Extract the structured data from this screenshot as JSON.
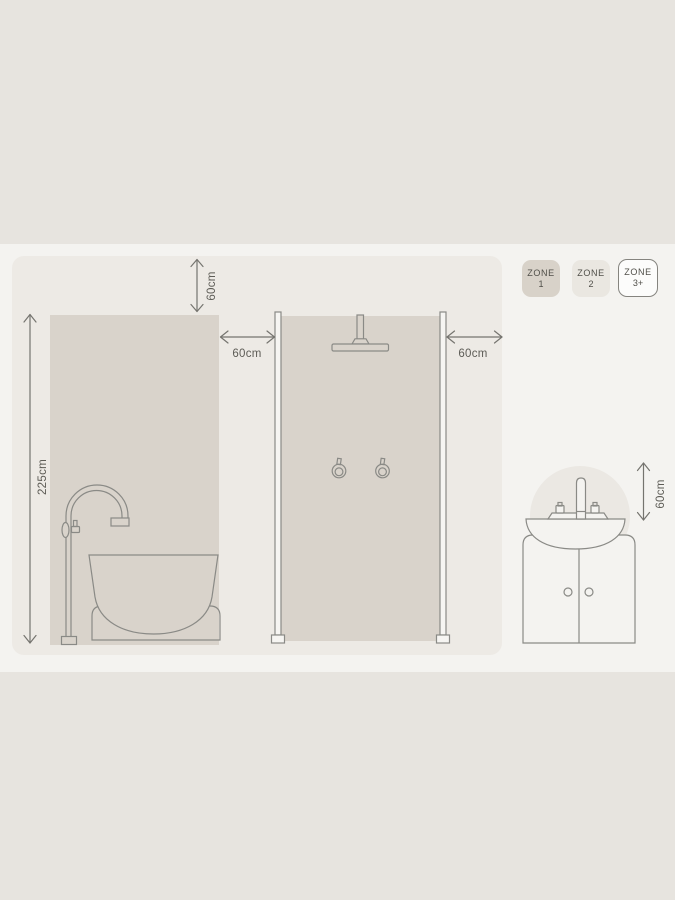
{
  "palette": {
    "background": "#e7e4df",
    "band": "#f4f3f0",
    "wall_panel": "#edeae5",
    "zone1_fill": "#d9d3cb",
    "zone2_badge_fill": "#eae7e1",
    "zone3_badge_fill": "#fcfcfb",
    "outline": "#8a8a86",
    "arrow": "#75746f",
    "text": "#55544e"
  },
  "legend": {
    "zone1": {
      "title": "ZONE",
      "value": "1"
    },
    "zone2": {
      "title": "ZONE",
      "value": "2"
    },
    "zone3": {
      "title": "ZONE",
      "value": "3+"
    }
  },
  "measurements": {
    "ceiling_clearance": "60cm",
    "zone_height": "225cm",
    "bath_side_clearance": "60cm",
    "shower_side_clearance": "60cm",
    "basin_clearance": "60cm"
  }
}
